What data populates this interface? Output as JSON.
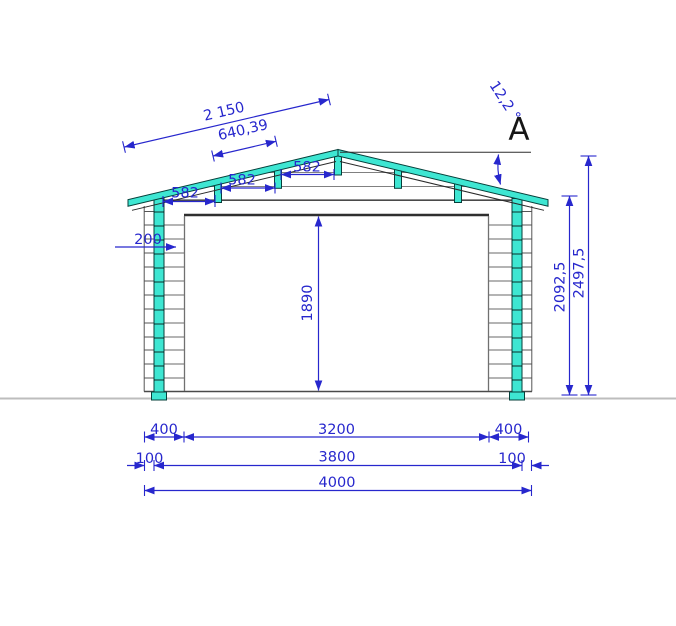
{
  "drawing": {
    "view_label": "A",
    "angle_label": "12,2 °",
    "dims": {
      "slope_total": "2 150",
      "slope_purlin": "640,39",
      "purlin_spacings": [
        "582",
        "582",
        "582"
      ],
      "wall_offset": "200",
      "door_height": "1890",
      "wall_height": "2092,5",
      "total_height": "2497,5",
      "row1": [
        "400",
        "3200",
        "400"
      ],
      "row2": [
        "100",
        "3800",
        "100"
      ],
      "row3": "4000"
    },
    "colors": {
      "dimension": "#2727cd",
      "timber": "#3ee6d2",
      "outline": "#2f2f2f",
      "ground": "#bdbdbd"
    }
  }
}
